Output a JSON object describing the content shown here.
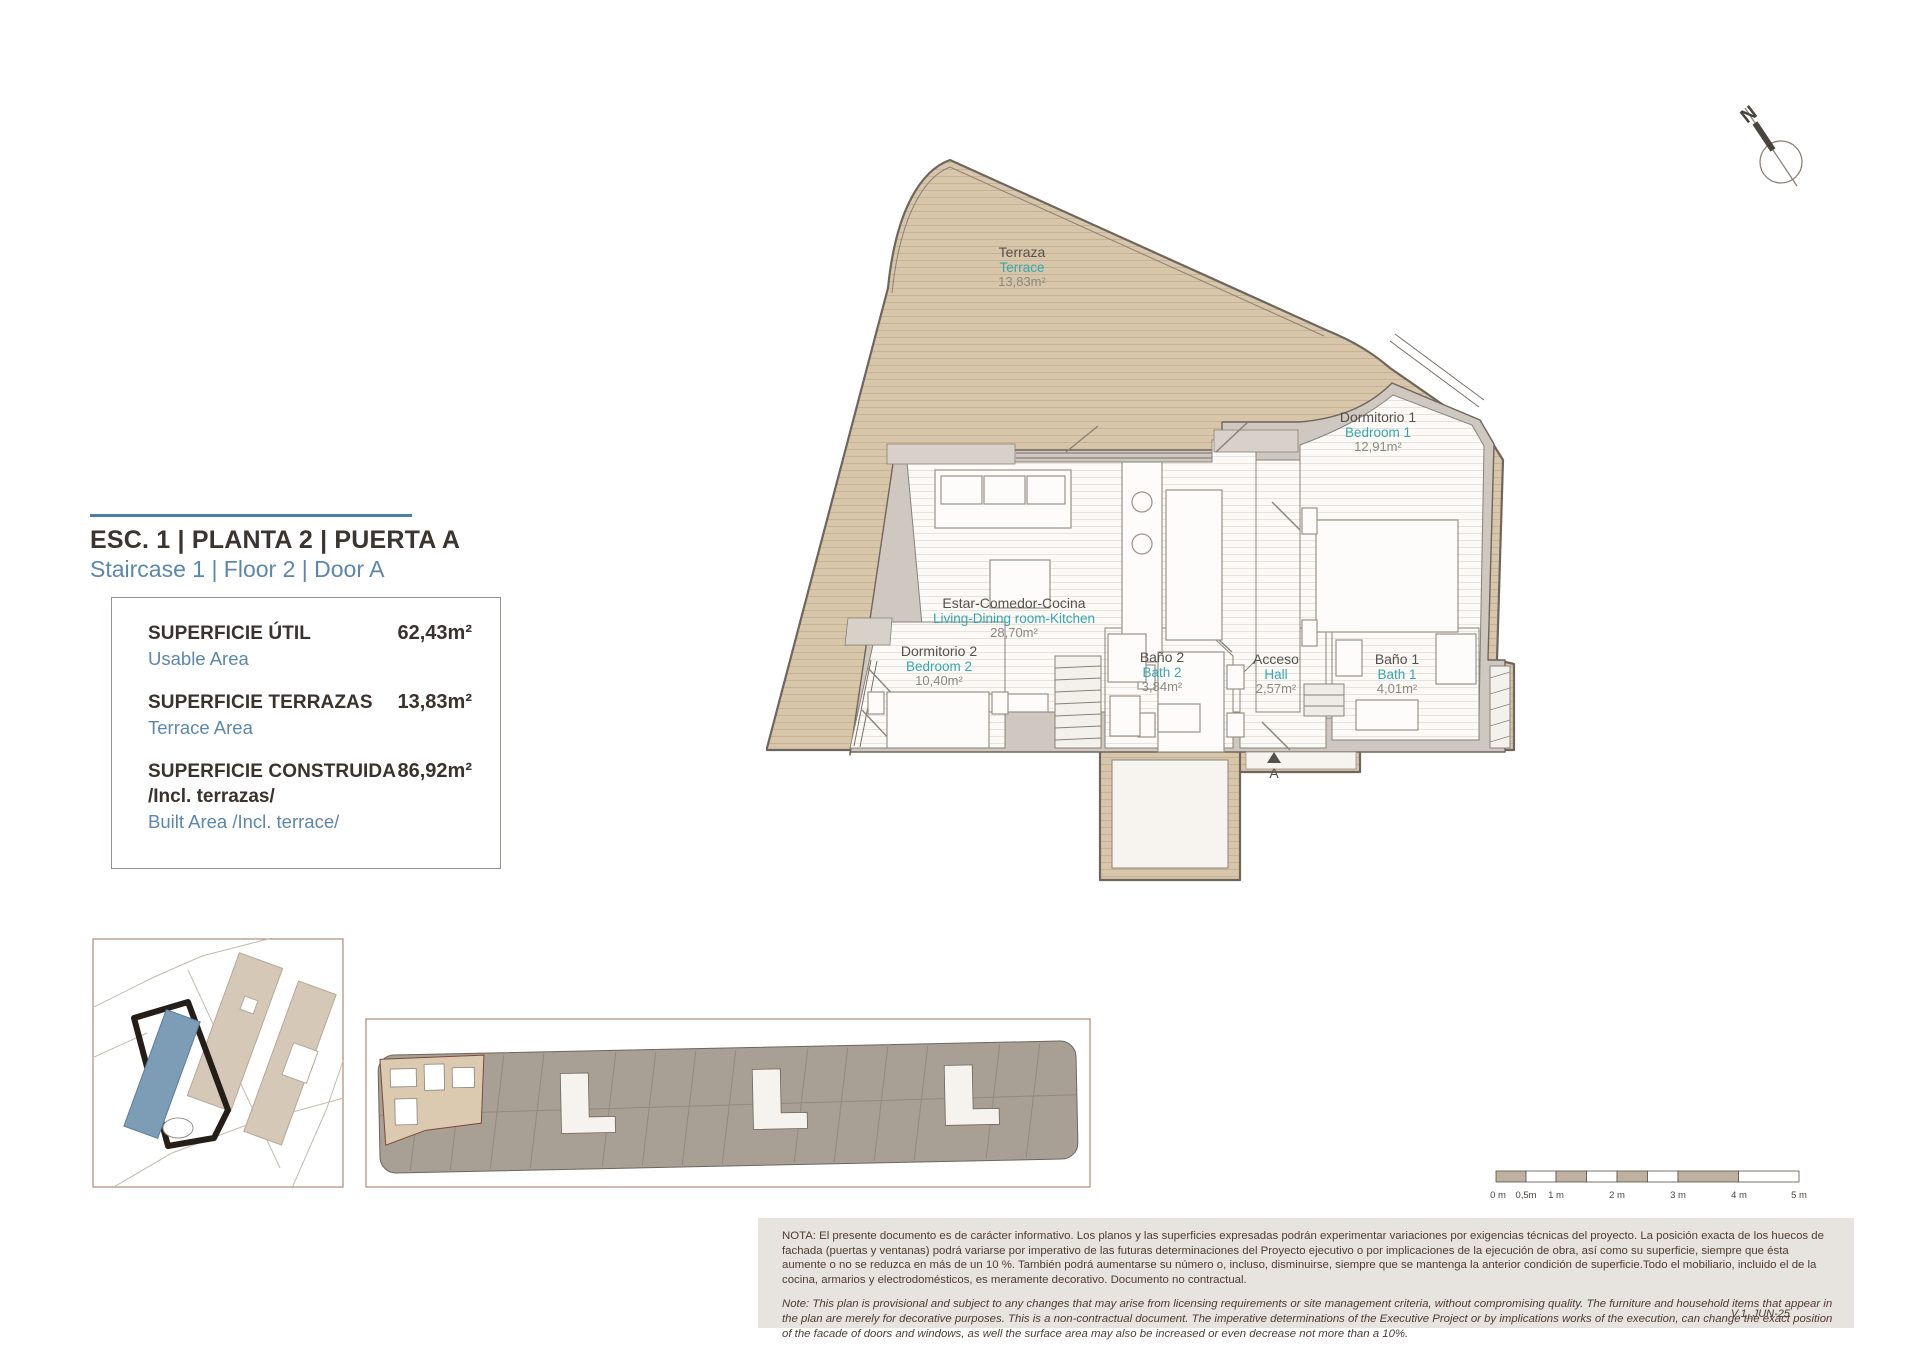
{
  "header": {
    "title_es": "ESC. 1 | PLANTA 2 | PUERTA A",
    "title_en": "Staircase 1 | Floor 2 | Door A"
  },
  "areas": {
    "rows": [
      {
        "label_es": "SUPERFICIE ÚTIL",
        "label_en": "Usable Area",
        "value": "62,43m²"
      },
      {
        "label_es": "SUPERFICIE TERRAZAS",
        "label_en": "Terrace Area",
        "value": "13,83m²"
      },
      {
        "label_es": "SUPERFICIE CONSTRUIDA",
        "label_es2": "/Incl. terrazas/",
        "label_en": "Built Area /Incl. terrace/",
        "value": "86,92m²"
      }
    ]
  },
  "plan": {
    "rooms": [
      {
        "es": "Terraza",
        "en": "Terrace",
        "area": "13,83m²"
      },
      {
        "es": "Estar-Comedor-Cocina",
        "en": "Living-Dining room-Kitchen",
        "area": "28,70m²"
      },
      {
        "es": "Dormitorio 1",
        "en": "Bedroom 1",
        "area": "12,91m²"
      },
      {
        "es": "Dormitorio 2",
        "en": "Bedroom 2",
        "area": "10,40m²"
      },
      {
        "es": "Baño 2",
        "en": "Bath 2",
        "area": "3,84m²"
      },
      {
        "es": "Acceso",
        "en": "Hall",
        "area": "2,57m²"
      },
      {
        "es": "Baño 1",
        "en": "Bath 1",
        "area": "4,01m²"
      }
    ],
    "entry_label": "A",
    "north_label": "N"
  },
  "scalebar": {
    "labels": [
      "0 m",
      "0,5m",
      "1 m",
      "2 m",
      "3 m",
      "4 m",
      "5 m"
    ]
  },
  "notes": {
    "nota_es": "NOTA:  El presente documento es de carácter informativo. Los planos y las superficies expresadas podrán experimentar variaciones por exigencias técnicas del proyecto. La posición exacta de los huecos de fachada (puertas y ventanas) podrá variarse por imperativo de las futuras determinaciones del Proyecto ejecutivo o por implicaciones de la ejecución de obra, así como su superficie, siempre que ésta aumente o no se reduzca en más de un 10 %. También podrá aumentarse su número o, incluso, disminuirse, siempre que se mantenga la anterior condición de superficie.Todo el mobiliario, incluido el de la cocina, armarios y electrodomésticos, es meramente decorativo. Documento no contractual.",
    "note_en": "Note: This plan is provisional and subject to any changes that may arise from licensing requirements or site management criteria, without compromising quality. The furniture and household items that appear in the plan are merely for decorative purposes. This is a non-contractual document. The imperative determinations of the Executive Project or by implications works of the execution, can change the exact position of the facade of doors and windows, as well the surface area may also be increased or even decrease not more than a 10%.",
    "version": "V.1_JUN-25"
  },
  "colors": {
    "accent_blue": "#4c7fa7",
    "teal": "#35a8ad",
    "terrace_tan": "#d8c6ab",
    "wall_gray": "#cfc8c0",
    "site_highlight_blue": "#7d9cb5"
  }
}
